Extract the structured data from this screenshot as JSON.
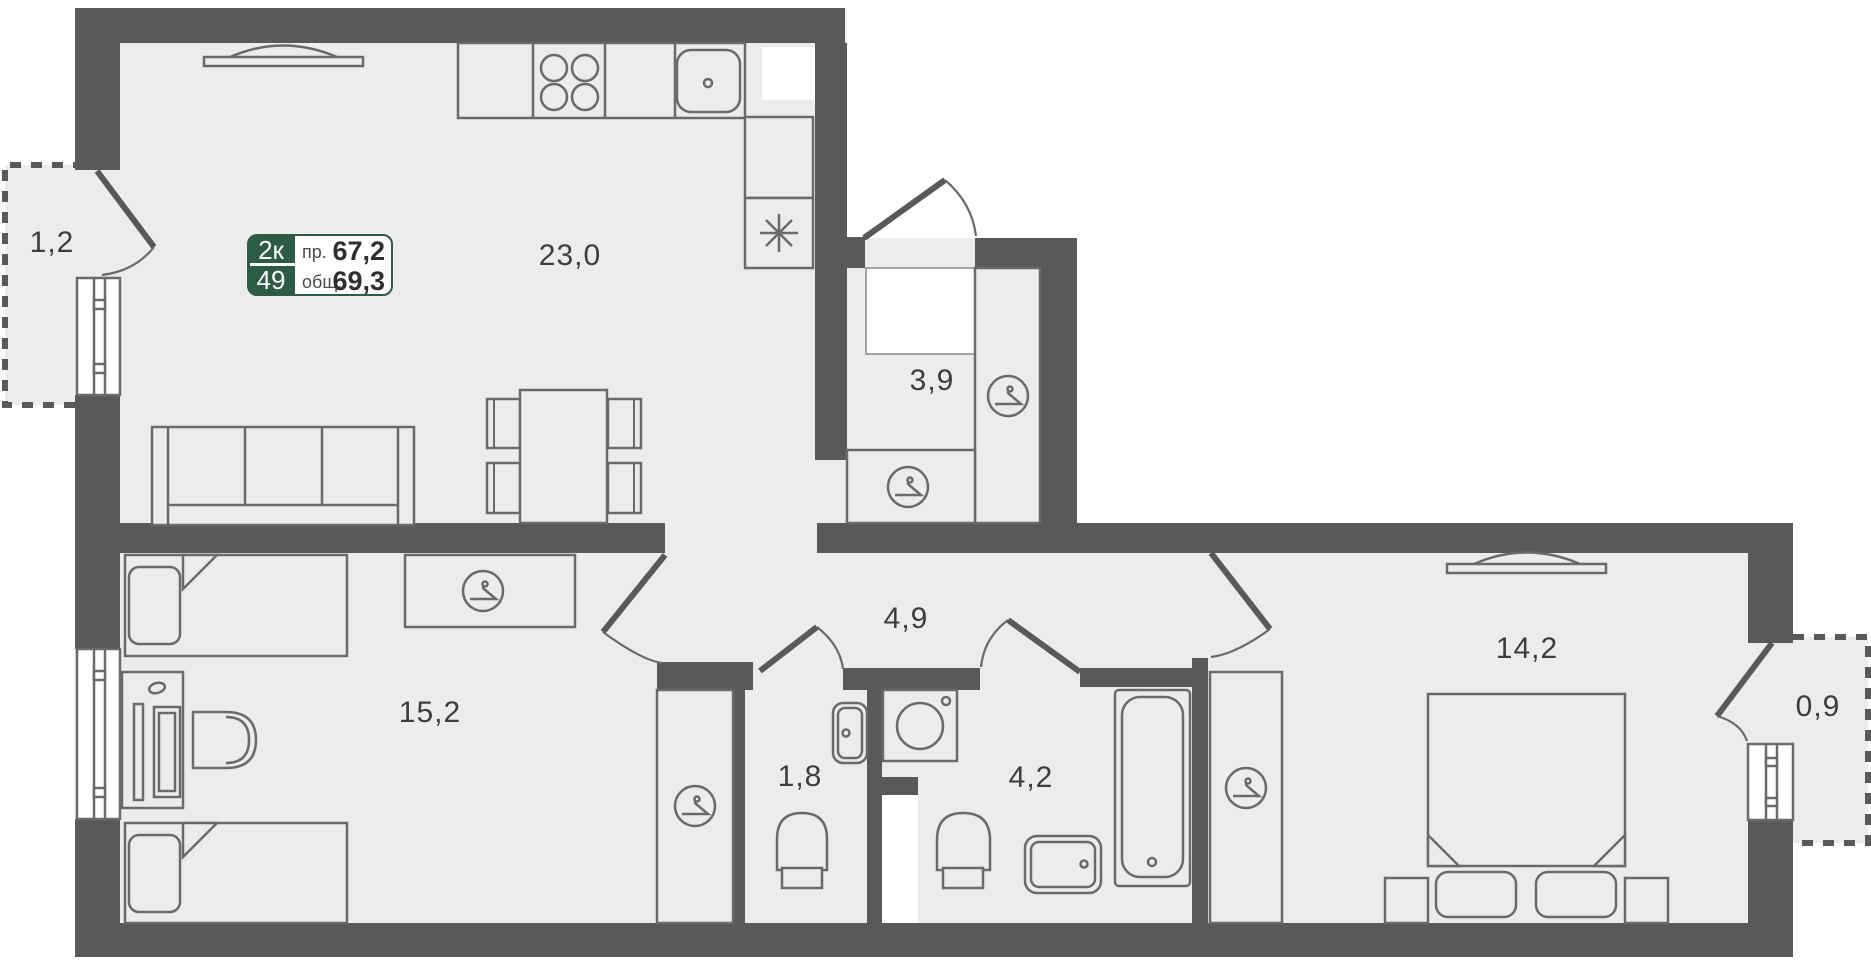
{
  "plan": {
    "badge": {
      "rooms_label": "2к",
      "unit_number": "49",
      "living_area_label": "пр.",
      "living_area_value": "67,2",
      "total_area_label": "общ.",
      "total_area_value": "69,3"
    },
    "rooms": [
      {
        "name": "balcony-left",
        "area": "1,2"
      },
      {
        "name": "kitchen-living-room",
        "area": "23,0"
      },
      {
        "name": "entry-hall",
        "area": "3,9"
      },
      {
        "name": "corridor",
        "area": "4,9"
      },
      {
        "name": "bedroom-left",
        "area": "15,2"
      },
      {
        "name": "wc",
        "area": "1,8"
      },
      {
        "name": "bathroom",
        "area": "4,2"
      },
      {
        "name": "bedroom-right",
        "area": "14,2"
      },
      {
        "name": "balcony-right",
        "area": "0,9"
      }
    ],
    "colors": {
      "wall": "#59595c",
      "floor": "#ececec",
      "line": "#6a6a6d",
      "badge_green": "#2d5c44",
      "text": "#3d3d3f"
    }
  }
}
